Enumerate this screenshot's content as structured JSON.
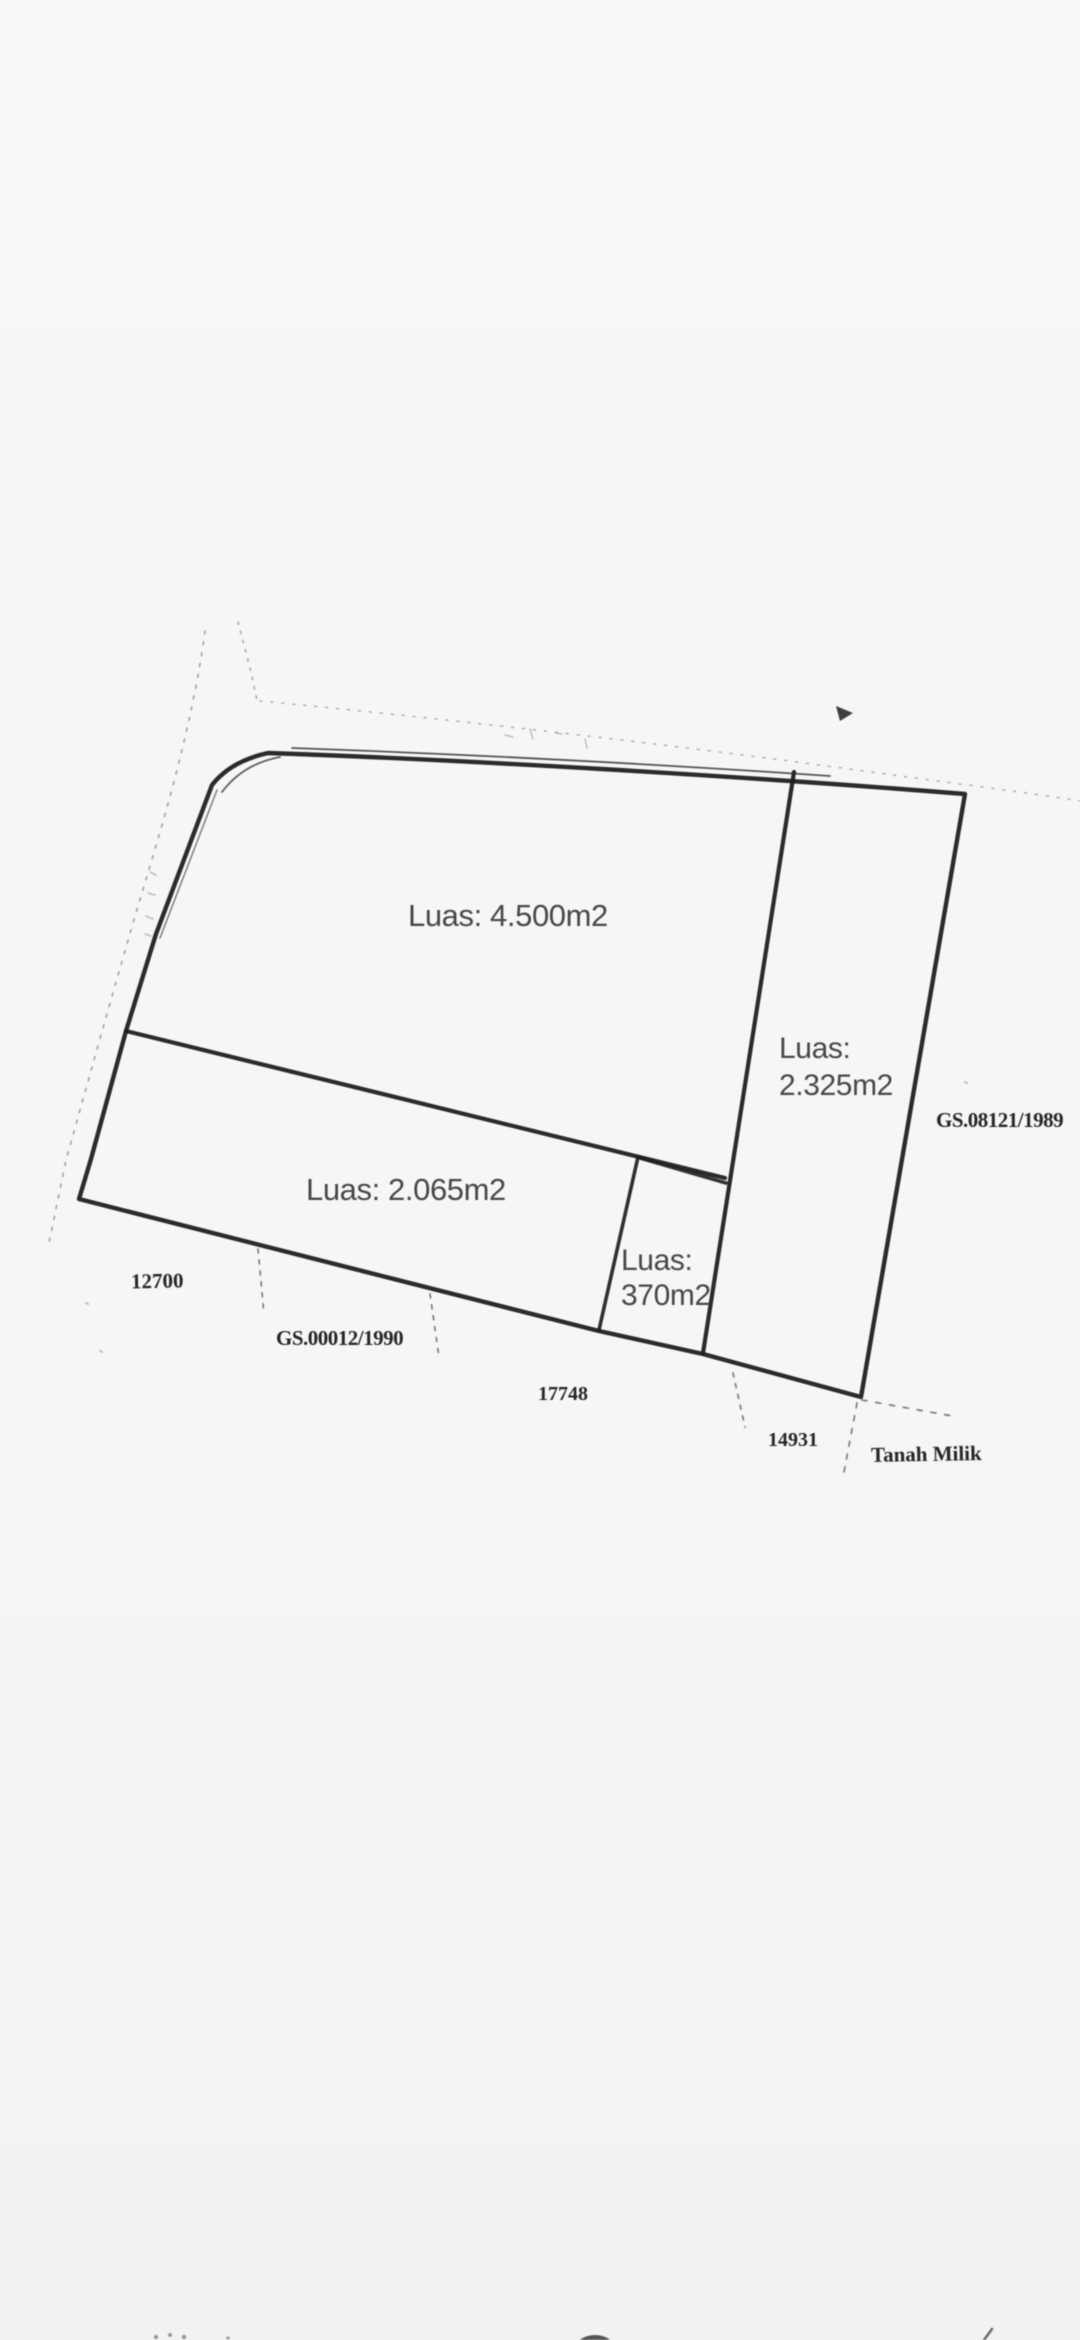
{
  "document": {
    "type": "scanned-land-survey-sketch",
    "background": "#f6f6f4"
  },
  "sketch": {
    "colors": {
      "boundary_line": "#1e1e1e",
      "faint_line": "#7d7d7d",
      "label_sans": "#474747",
      "label_serif": "#262626"
    },
    "plots": {
      "p4500": {
        "label": "Luas: 4.500m2"
      },
      "p2325": {
        "line1": "Luas:",
        "line2": "2.325m2"
      },
      "p2065": {
        "label": "Luas: 2.065m2"
      },
      "p370": {
        "line1": "Luas:",
        "line2": "370m2"
      }
    },
    "annotations": {
      "gs_right": "GS.08121/1989",
      "dim_12700": "12700",
      "gs_bottom": "GS.00012/1990",
      "dim_17748": "17748",
      "dim_14931": "14931",
      "tanah_milik": "Tanah Milik"
    },
    "marks": [
      "road-dashed-line",
      "survey-tick-marks",
      "north-smudge-mark",
      "cropped-dots",
      "cropped-dark-blob",
      "cropped-tick"
    ]
  }
}
